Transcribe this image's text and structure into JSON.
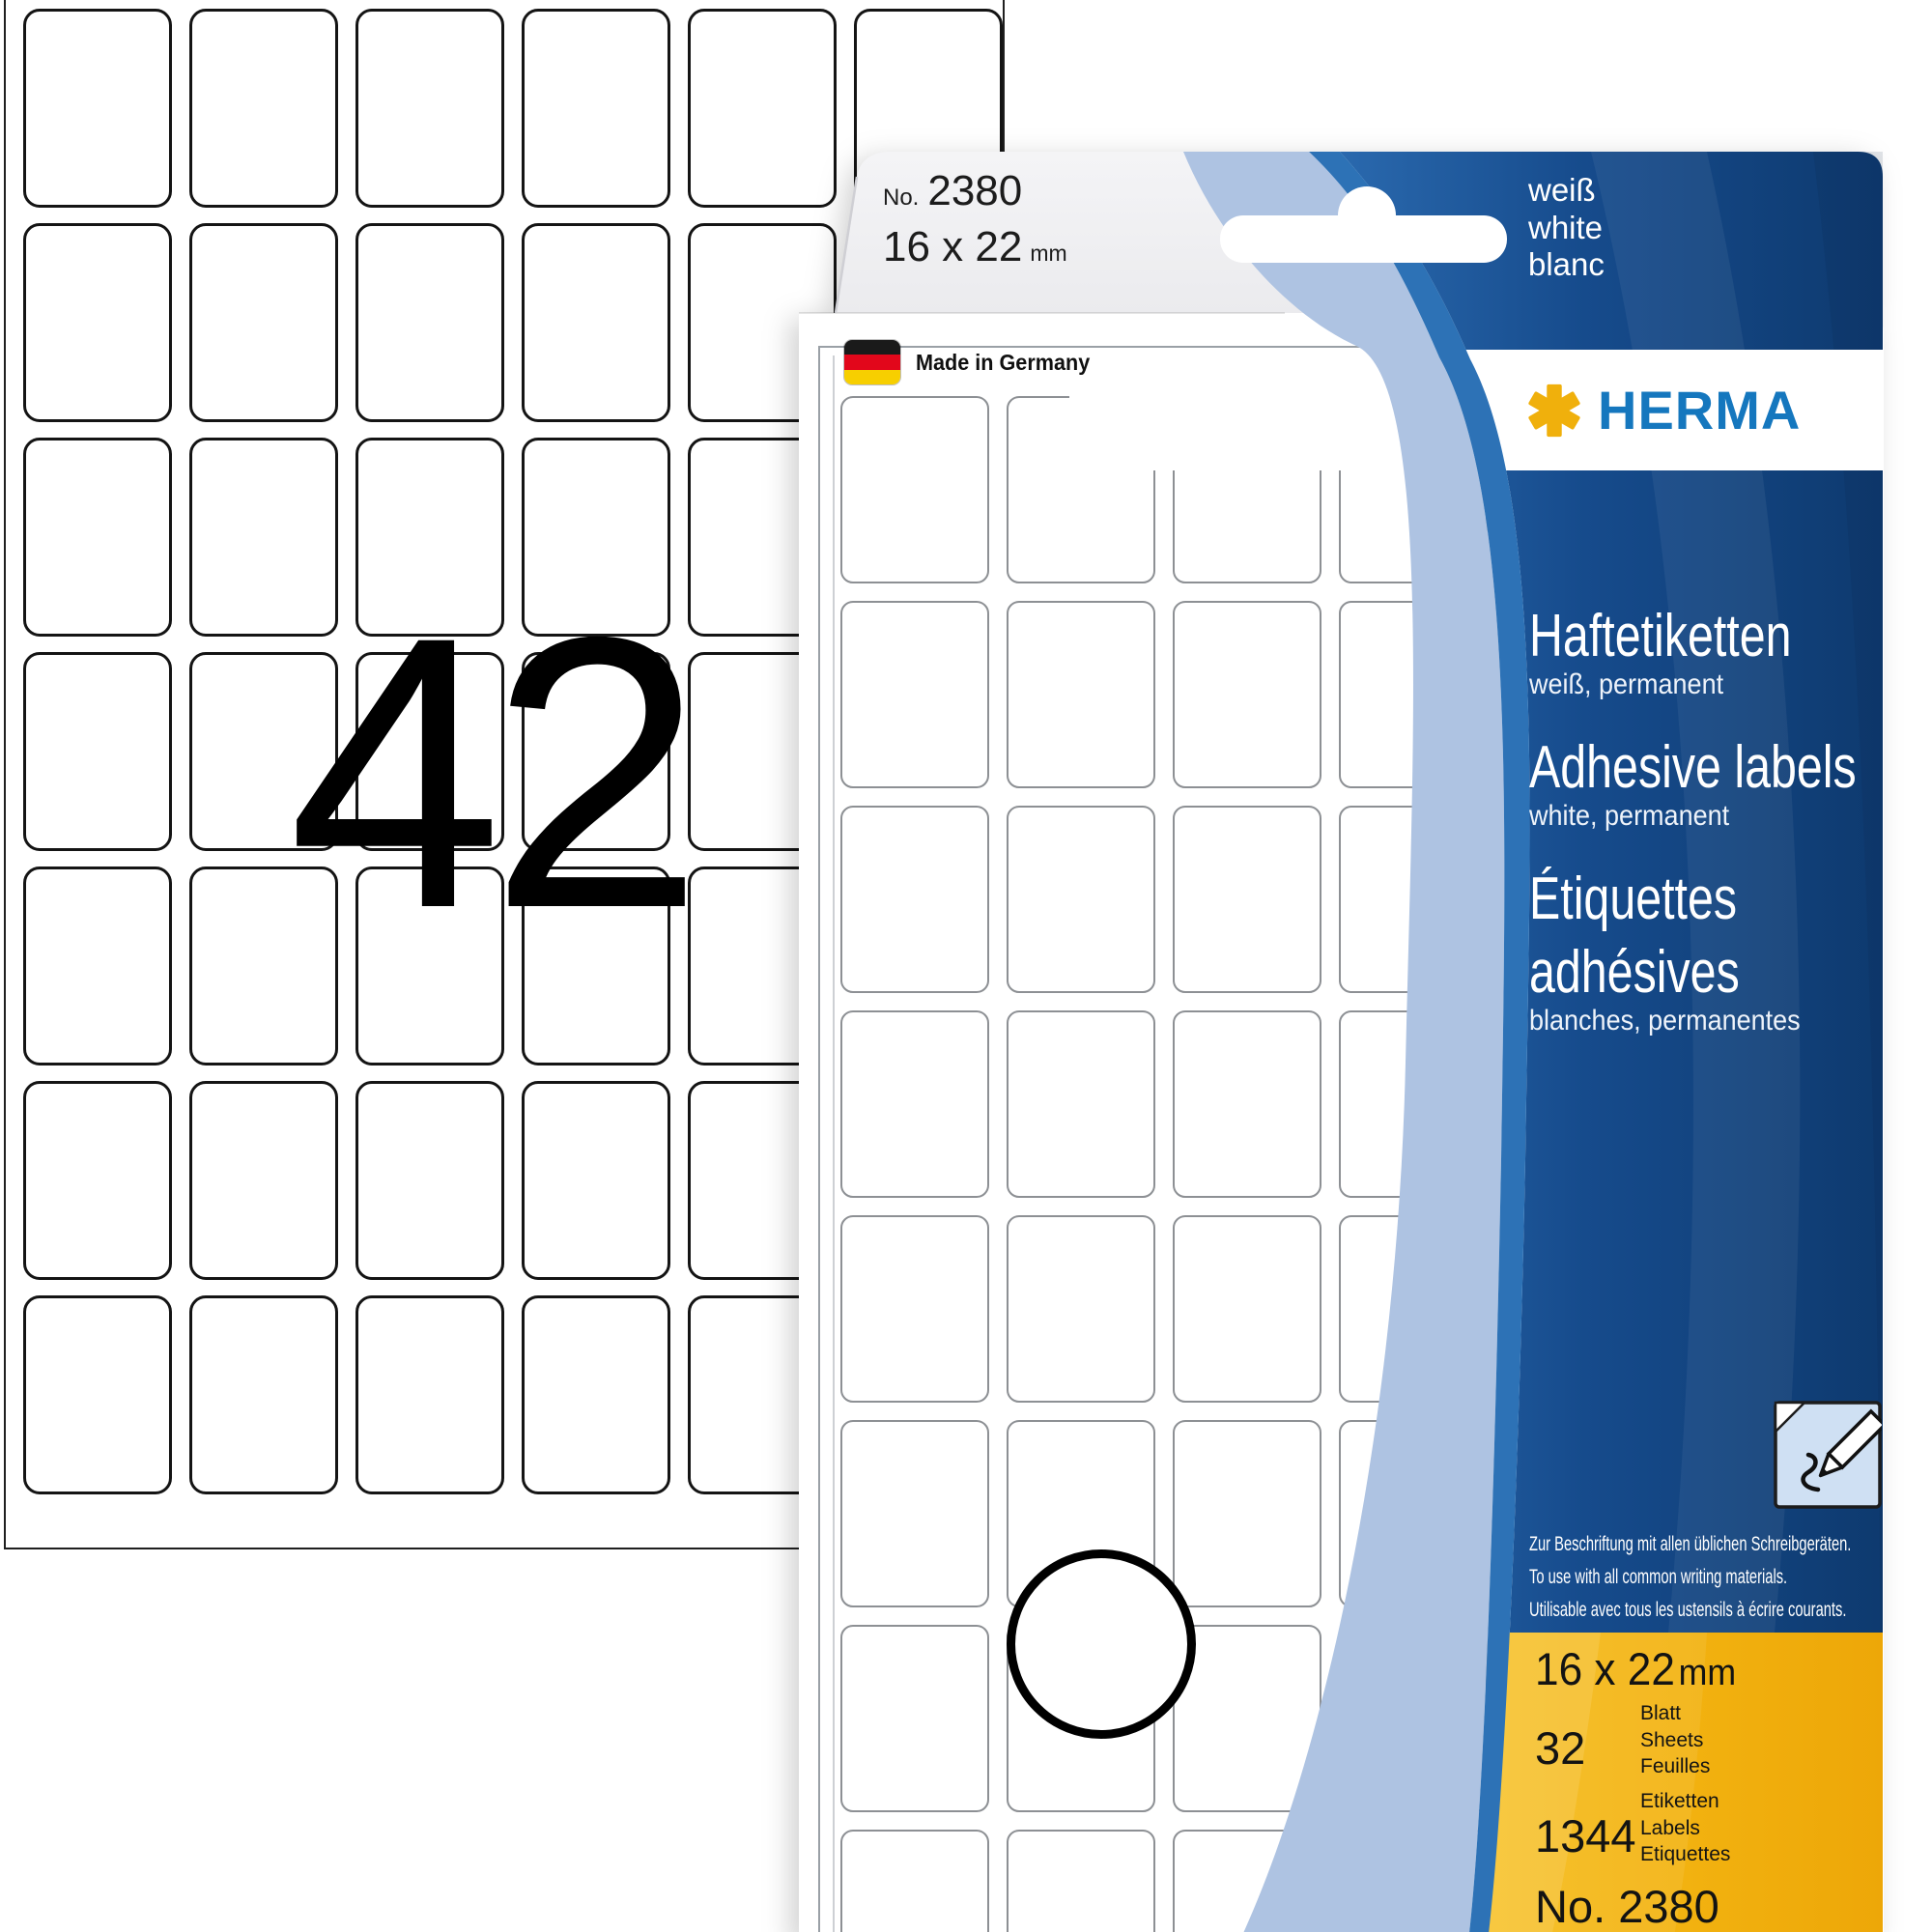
{
  "left_sheet": {
    "count_overlay": "42",
    "cols": 6,
    "rows": 7
  },
  "inner_sheet": {
    "cols": 4,
    "rows": 8
  },
  "tab": {
    "no_prefix": "No.",
    "no_value": "2380",
    "size_value": "16 x 22",
    "size_unit": "mm"
  },
  "flap": {
    "lang_lines": [
      "weiß",
      "white",
      "blanc"
    ]
  },
  "window": {
    "made_in": "Made in Germany"
  },
  "brand": {
    "wordmark": "HERMA"
  },
  "panel": {
    "de_title": "Haftetiketten",
    "de_sub": "weiß, permanent",
    "en_title": "Adhesive labels",
    "en_sub": "white, permanent",
    "fr_title_line1": "Étiquettes",
    "fr_title_line2": "adhésives",
    "fr_sub": "blanches, permanentes",
    "usage_de": "Zur Beschriftung mit allen üblichen Schreibgeräten.",
    "usage_en": "To use with all common writing materials.",
    "usage_fr": "Utilisable avec tous les ustensils à écrire courants."
  },
  "specs": {
    "size_value": "16 x 22",
    "size_unit": "mm",
    "sheets_value": "32",
    "sheets_units": [
      "Blatt",
      "Sheets",
      "Feuilles"
    ],
    "labels_value": "1344",
    "labels_units": [
      "Etiketten",
      "Labels",
      "Etiquettes"
    ],
    "order_no": "No. 2380"
  },
  "colors": {
    "herma_blue": "#1577be",
    "herma_yellow": "#f0b00c",
    "navy": "#10417c",
    "medium_blue": "#2d72b6",
    "light_blue": "#aec3e2",
    "yellow_panel": "#f3b30d"
  }
}
